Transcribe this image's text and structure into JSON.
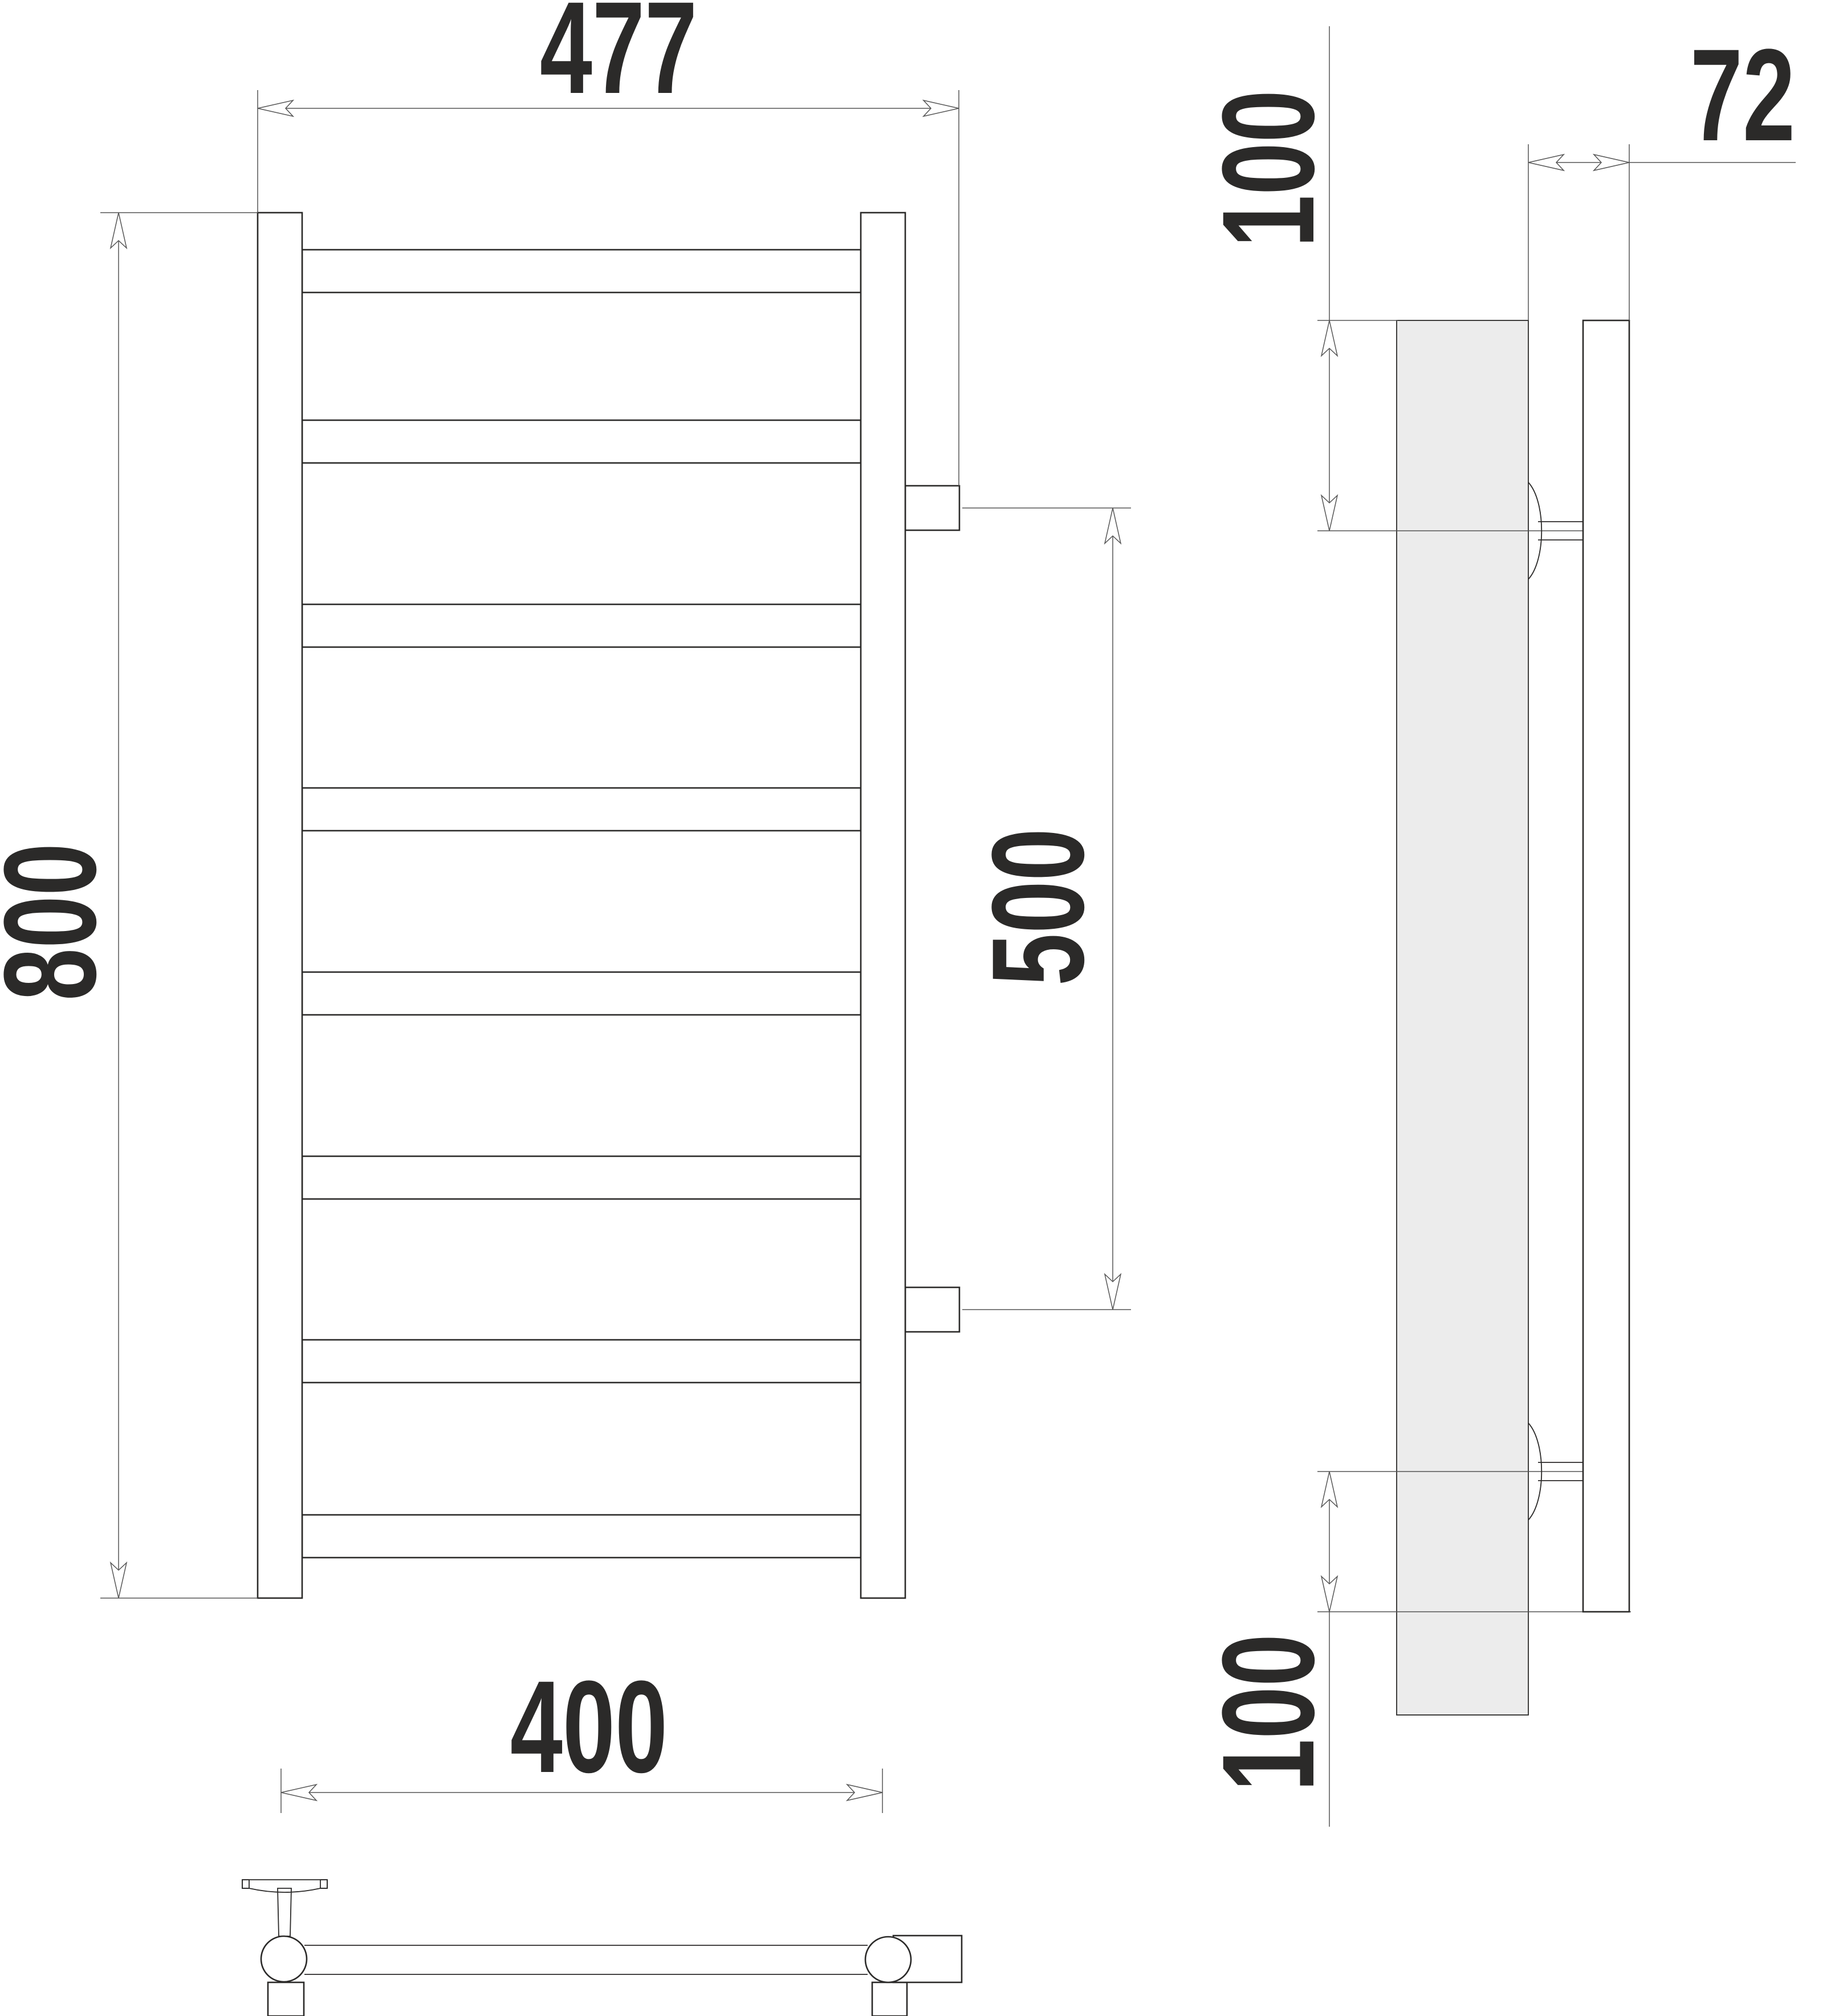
{
  "dims": {
    "front_overall_width": "477",
    "front_overall_height": "800",
    "post_center_spacing": "400",
    "connection_spacing": "500",
    "top_bracket_offset": "100",
    "bottom_bracket_offset": "100",
    "wall_depth": "72"
  },
  "colors": {
    "line": "#2b2a29",
    "dim": "#555555",
    "wall_fill": "#ececec",
    "ink": "#2b2a29",
    "background": "#ffffff"
  }
}
